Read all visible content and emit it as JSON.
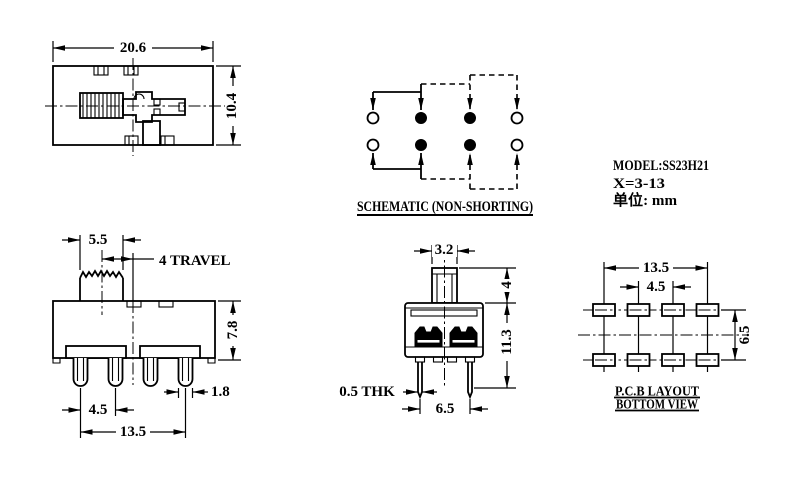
{
  "top_view": {
    "width_dim": "20.6",
    "height_dim": "10.4"
  },
  "schematic": {
    "title": "SCHEMATIC (NON-SHORTING)"
  },
  "info": {
    "model": "MODEL:SS23H21",
    "travel_range": "X=3-13",
    "unit": "单位: mm"
  },
  "front_view": {
    "knob_width": "5.5",
    "travel": "4 TRAVEL",
    "height": "7.8",
    "pin_pitch": "4.5",
    "pin_span": "13.5",
    "pin_width": "1.8"
  },
  "side_view": {
    "knob_width": "3.2",
    "knob_height": "4",
    "height": "11.3",
    "thickness": "0.5 THK",
    "leg_pitch": "6.5"
  },
  "pcb": {
    "pad_span": "13.5",
    "pad_pitch": "4.5",
    "row_pitch": "6.5",
    "title1": "P.C.B LAYOUT",
    "title2": "BOTTOM VIEW"
  }
}
